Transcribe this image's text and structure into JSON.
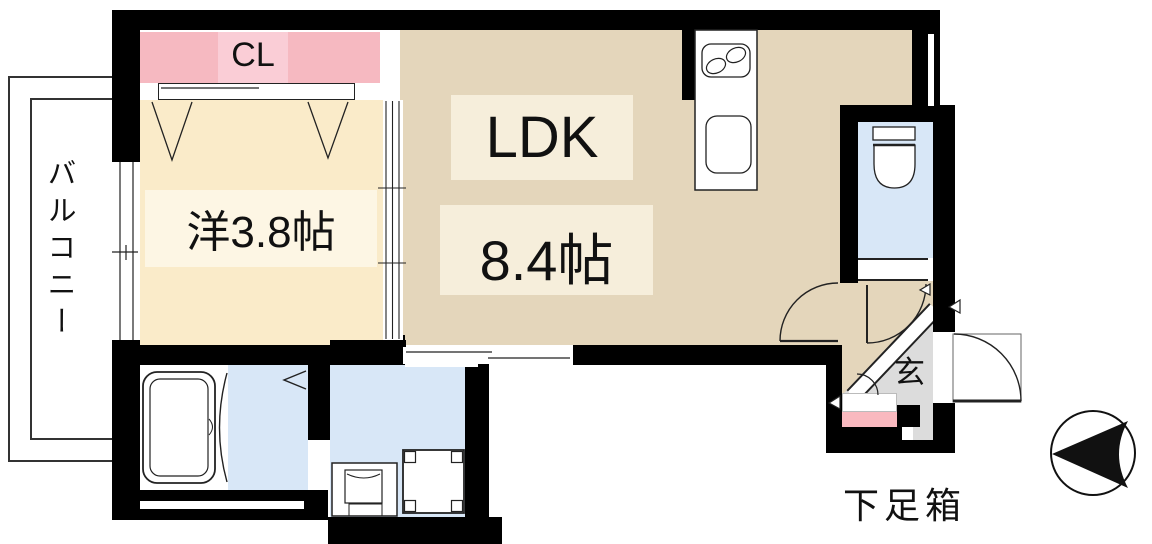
{
  "plan": {
    "closet_label": "CL",
    "balcony_label": "バルコニー",
    "western_room_label": "洋3.8帖",
    "ldk_label": "LDK",
    "ldk_size_label": "8.4帖",
    "entrance_label": "玄",
    "shoe_box_label": "下足箱"
  },
  "colors": {
    "wall": "#000000",
    "western_room_floor": "#FAEBC9",
    "western_room_label_bg": "#FDF6E4",
    "ldk_floor": "#E4D6BB",
    "ldk_label_bg": "#F6EEDB",
    "closet_pink": "#F6B9C1",
    "closet_label_bg": "#FACDD6",
    "shoe_box_pink": "#F9B9BF",
    "water_area_blue": "#D8E7F7",
    "genkan_gray": "#DCDCDC"
  },
  "icons": {
    "compass": "north-arrow-pointing-left"
  }
}
